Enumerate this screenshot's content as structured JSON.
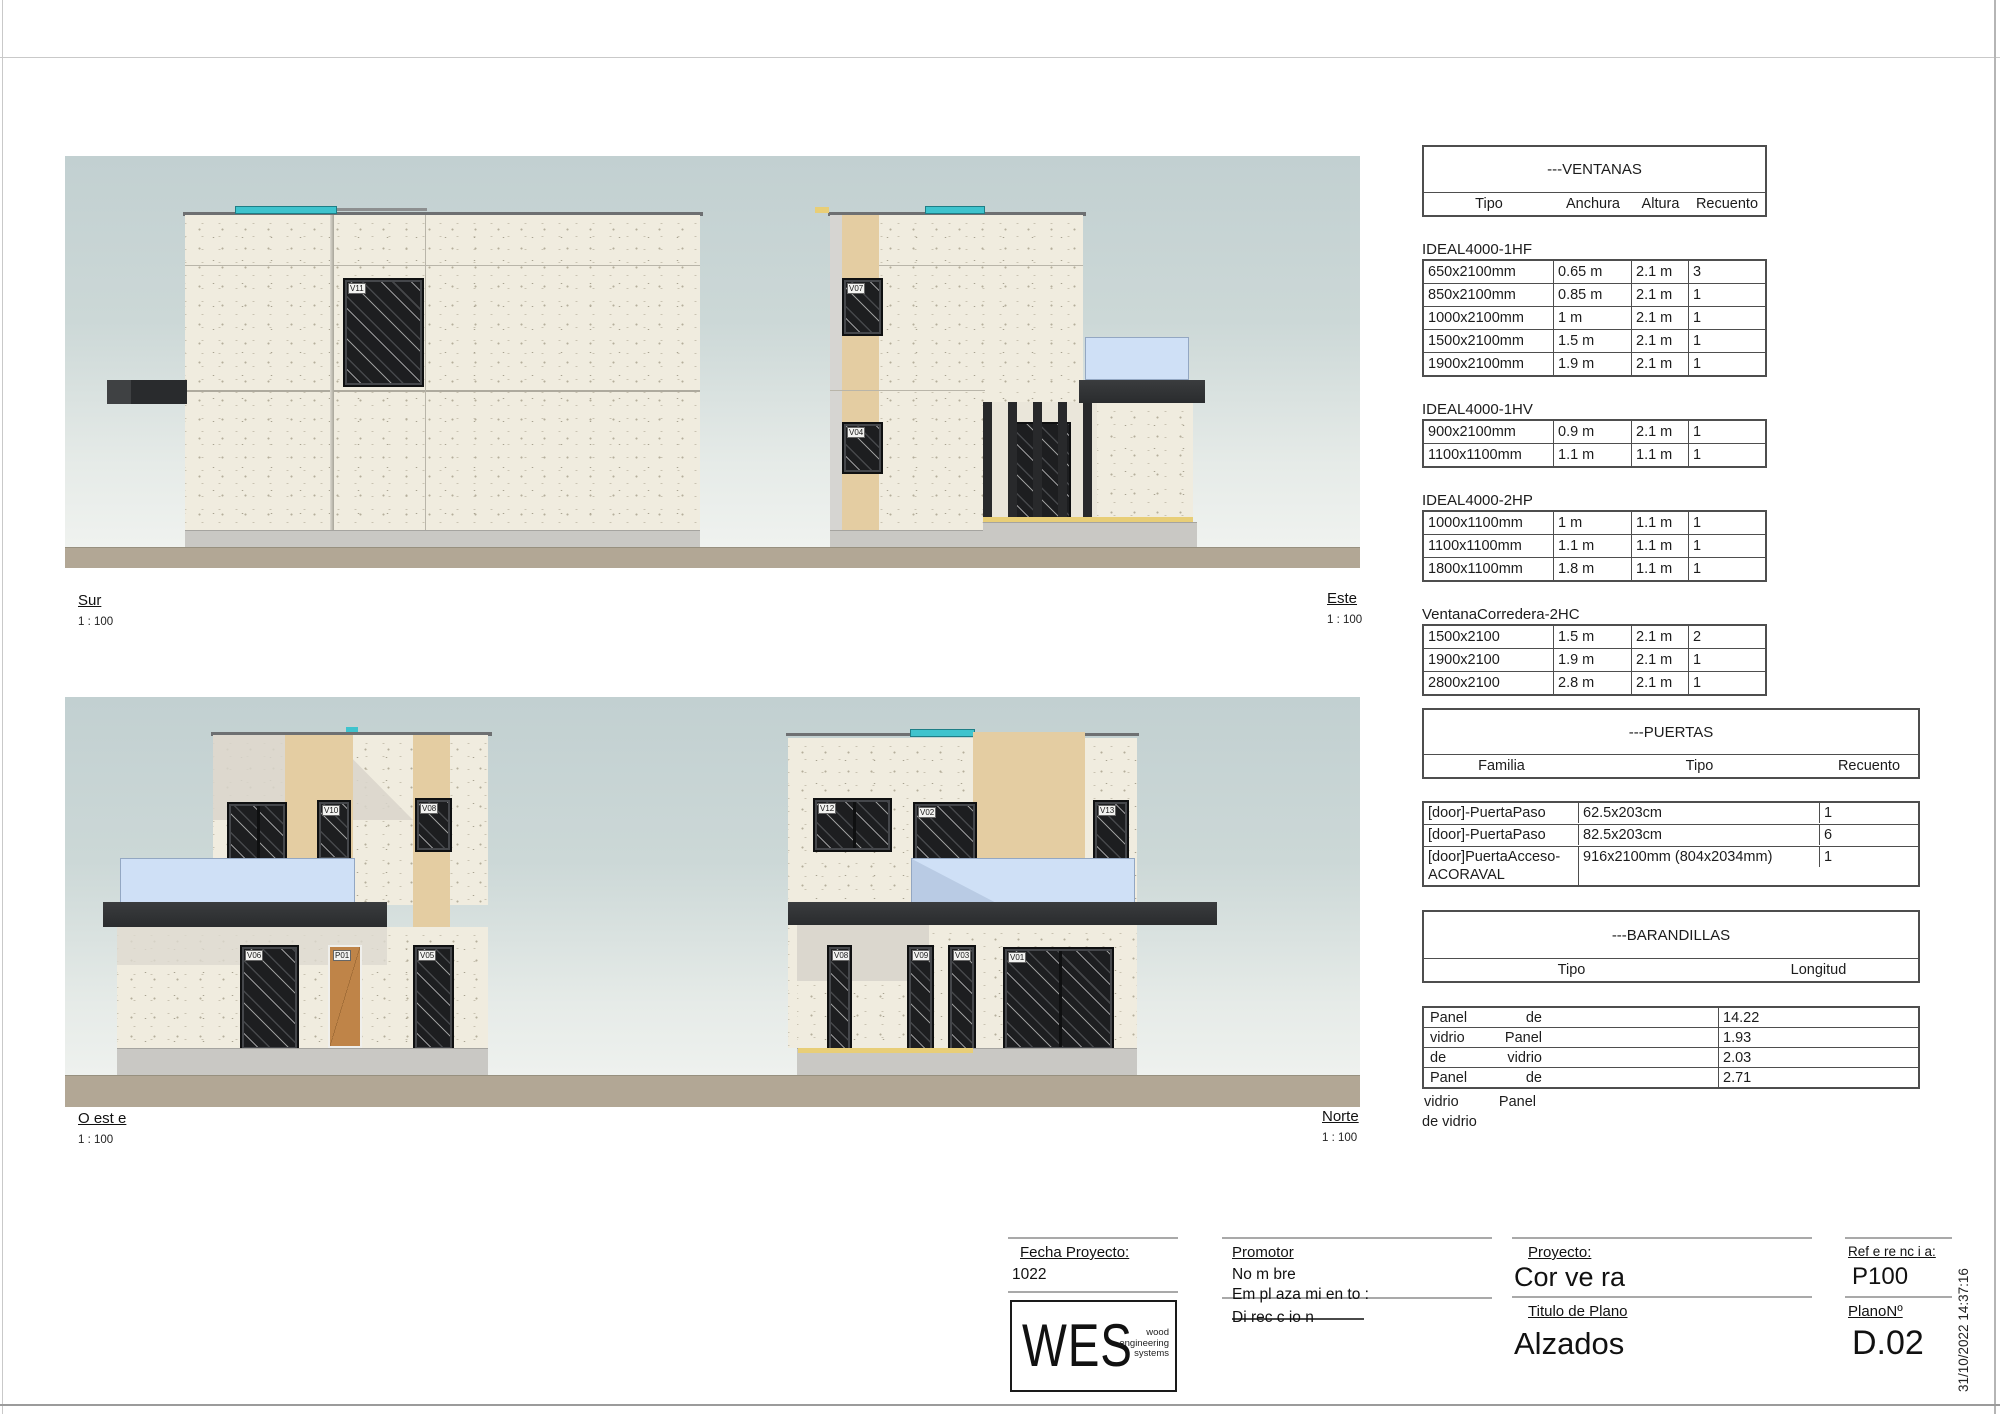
{
  "sheet": {
    "timestamp": "31/10/2022 14:37:16"
  },
  "palette": {
    "sky_top": "#c2d0d1",
    "sky_bottom": "#f2f4f1",
    "wall": "#f0ecdf",
    "tan": "#e4cda2",
    "glass_rail": "#cfe0f6",
    "canopy": "#2a2c2e",
    "ground": "#b2a795",
    "teal": "#3fc3cd",
    "door_wood": "#bf8448",
    "accent_yellow": "#e8ce77"
  },
  "elevations": [
    {
      "label": "Sur",
      "scale": "1 : 100",
      "tags": [
        "V11"
      ]
    },
    {
      "label": "Este",
      "scale": "1 : 100",
      "tags": [
        "V07",
        "V04"
      ]
    },
    {
      "label": "O est e",
      "scale": "1 : 100",
      "tags": [
        "V10",
        "V08",
        "V06",
        "P01",
        "V05"
      ]
    },
    {
      "label": "Norte",
      "scale": "1 : 100",
      "tags": [
        "V12",
        "V02",
        "V13",
        "V08",
        "V09",
        "V03",
        "V01"
      ]
    }
  ],
  "ventanas": {
    "title": "---VENTANAS",
    "columns": [
      "Tipo",
      "Anchura",
      "Altura",
      "Recuento"
    ],
    "groups": [
      {
        "name": "IDEAL4000-1HF",
        "rows": [
          [
            "650x2100mm",
            "0.65 m",
            "2.1 m",
            "3"
          ],
          [
            "850x2100mm",
            "0.85 m",
            "2.1 m",
            "1"
          ],
          [
            "1000x2100mm",
            "1 m",
            "2.1 m",
            "1"
          ],
          [
            "1500x2100mm",
            "1.5 m",
            "2.1 m",
            "1"
          ],
          [
            "1900x2100mm",
            "1.9 m",
            "2.1 m",
            "1"
          ]
        ]
      },
      {
        "name": "IDEAL4000-1HV",
        "rows": [
          [
            "900x2100mm",
            "0.9 m",
            "2.1 m",
            "1"
          ],
          [
            "1100x1100mm",
            "1.1 m",
            "1.1 m",
            "1"
          ]
        ]
      },
      {
        "name": "IDEAL4000-2HP",
        "rows": [
          [
            "1000x1100mm",
            "1 m",
            "1.1 m",
            "1"
          ],
          [
            "1100x1100mm",
            "1.1 m",
            "1.1 m",
            "1"
          ],
          [
            "1800x1100mm",
            "1.8 m",
            "1.1 m",
            "1"
          ]
        ]
      },
      {
        "name": "VentanaCorredera-2HC",
        "rows": [
          [
            "1500x2100",
            "1.5 m",
            "2.1 m",
            "2"
          ],
          [
            "1900x2100",
            "1.9 m",
            "2.1 m",
            "1"
          ],
          [
            "2800x2100",
            "2.8 m",
            "2.1 m",
            "1"
          ]
        ]
      }
    ]
  },
  "puertas": {
    "title": "---PUERTAS",
    "columns": [
      "Familia",
      "Tipo",
      "Recuento"
    ],
    "rows": [
      [
        "[door]-PuertaPaso",
        "62.5x203cm",
        "1"
      ],
      [
        "[door]-PuertaPaso",
        "82.5x203cm",
        "6"
      ],
      [
        "[door]PuertaAcceso-ACORAVAL",
        "916x2100mm (804x2034mm)",
        "1"
      ]
    ]
  },
  "barandillas": {
    "title": "---BARANDILLAS",
    "columns": [
      "Tipo",
      "Longitud"
    ],
    "rows": [
      {
        "tipo_words": [
          "Panel",
          "de"
        ],
        "longitud": "14.22"
      },
      {
        "tipo_words": [
          "vidrio",
          "Panel"
        ],
        "longitud": "1.93"
      },
      {
        "tipo_words": [
          "de",
          "vidrio"
        ],
        "longitud": "2.03"
      },
      {
        "tipo_words": [
          "Panel",
          "de"
        ],
        "longitud": "2.71"
      }
    ],
    "overflow_words": [
      "vidrio",
      "Panel"
    ],
    "overflow_last": "de vidrio"
  },
  "titleblock": {
    "fecha_label": "Fecha Proyecto:",
    "fecha_value": "1022",
    "logo": {
      "text": "WES",
      "tagline": [
        "wood",
        "engineering",
        "systems"
      ]
    },
    "promotor_label": "Promotor",
    "promotor_nombre": "No m bre",
    "promotor_emplazamiento": "Em pl aza mi en to :",
    "promotor_direccion": "Di rec c io n",
    "proyecto_label": "Proyecto:",
    "proyecto_value": "Cor ve ra",
    "titulo_label": "Titulo de Plano",
    "titulo_value": "Alzados",
    "referencia_label": "Ref e re nc i a:",
    "referencia_value": "P100",
    "plano_label": "PlanoNº",
    "plano_value": "D.02"
  }
}
